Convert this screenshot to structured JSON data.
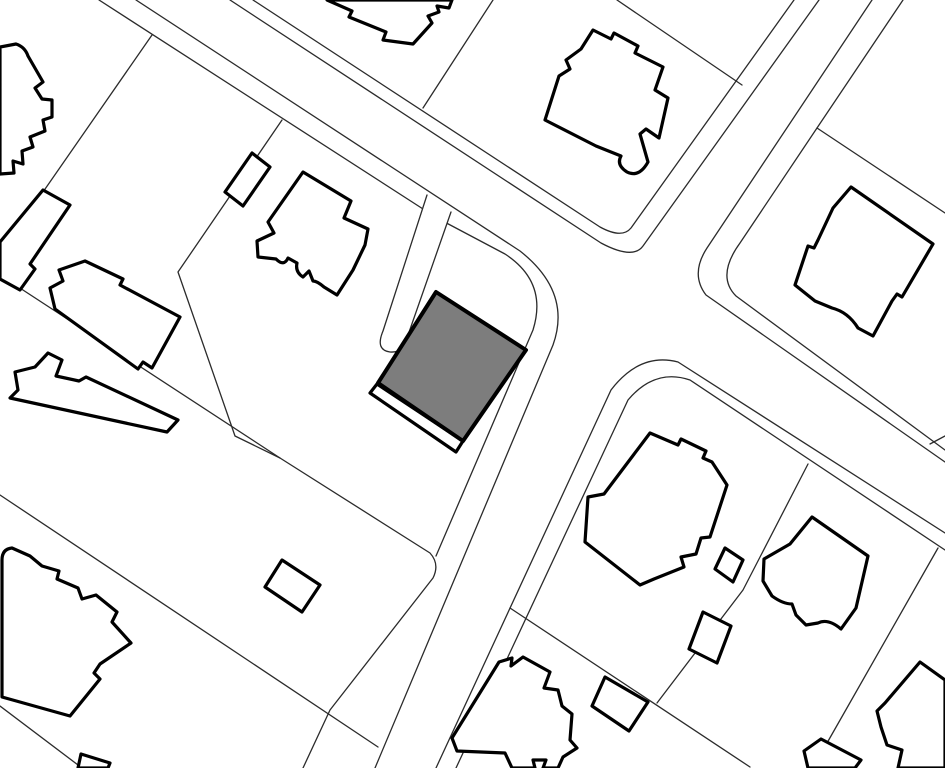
{
  "map": {
    "kind": "cadastral-parcel-map",
    "viewbox": "0 0 945 768",
    "background_color": "#ffffff",
    "parcel_line_color": "#2b2b2b",
    "parcel_line_width": 1.3,
    "building_stroke_color": "#000000",
    "building_stroke_width": 3.2,
    "building_fill": "#ffffff",
    "highlight_fill": "#7d7d7d",
    "highlight_stroke_width": 4,
    "roads": [
      {
        "name": "road-nw-ne-edge",
        "d": "M230,0 L601,243 Q633,260 643,246 L819,0"
      },
      {
        "name": "road-nw-ne-offset",
        "d": "M253,0 L600,227 Q622,239 631,228 L794,0"
      },
      {
        "name": "road-nw-sw-edge",
        "d": "M136,0 L520,251 Q572,292 553,345 L375,768"
      },
      {
        "name": "road-nw-sw-offset",
        "d": "M99,0 L437,218"
      },
      {
        "name": "road-n-e-edge",
        "d": "M872,0 L707,248 Q690,274 706,295 L945,462"
      },
      {
        "name": "road-n-e-offset",
        "d": "M903,0 L817,128 L740,243 Q716,276 736,296 L945,450"
      },
      {
        "name": "road-sw-e-edge",
        "d": "M436,768 L611,390 Q640,352 678,362 L945,533"
      },
      {
        "name": "road-sw-e-offset",
        "d": "M456,768 L628,400 Q655,368 690,380 L945,550"
      }
    ],
    "parcel_lines": [
      {
        "name": "parcel-line-tl",
        "d": "M152,35 L43,192"
      },
      {
        "name": "parcel-line-top-mid",
        "d": "M493,0 L423,108"
      },
      {
        "name": "parcel-line-top-right",
        "d": "M617,0 L742,85"
      },
      {
        "name": "parcel-line-ne",
        "d": "M817,128 L945,213"
      },
      {
        "name": "parcel-line-left-mid",
        "d": "M0,275 L280,458"
      },
      {
        "name": "parcel-line-left-low",
        "d": "M0,495 L378,747"
      },
      {
        "name": "parcel-line-corner-bl",
        "d": "M0,706 L82,768"
      },
      {
        "name": "parcel-line-w-offset-chain",
        "d": "M282,120 L178,272 L235,436 L280,458 L430,553 Q440,564 433,578 L330,710 L303,768"
      },
      {
        "name": "parcel-line-corner-lot",
        "d": "M437,218 L505,254 Q548,282 533,330 L436,556"
      },
      {
        "name": "parcel-line-se-diag",
        "d": "M510,608 L750,767"
      },
      {
        "name": "parcel-line-se-cross",
        "d": "M808,464 L743,590 L657,703"
      },
      {
        "name": "parcel-line-br-diag",
        "d": "M938,548 L827,743 L809,768"
      },
      {
        "name": "parcel-line-right-stub",
        "d": "M930,444 L945,436"
      }
    ],
    "driveway": {
      "name": "driveway-strip",
      "d": "M427,195 L383,331 Q375,350 390,352 Q405,353 407,338 L451,212"
    },
    "buildings": [
      {
        "name": "building-top-left",
        "d": "M0,47 L16,44 Q25,47 28,56 L43,82 L35,88 L42,99 L52,100 L52,117 L43,120 L45,131 L30,137 L33,147 L22,151 L23,164 L13,161 L14,173 L0,174 Z"
      },
      {
        "name": "building-left-narrow",
        "d": "M43,190 L70,205 L30,264 L35,269 L20,290 L0,279 L0,242 Z"
      },
      {
        "name": "building-left-mid",
        "d": "M85,261 L123,279 L120,285 L180,317 L152,368 L143,362 L138,369 L55,309 L50,288 L63,281 L59,270 Z"
      },
      {
        "name": "building-left-lower",
        "d": "M48,353 L62,360 L56,376 L79,381 L86,377 L178,420 L167,432 L10,398 L18,390 L15,372 L35,367 Z"
      },
      {
        "name": "building-bottom-left-house",
        "d": "M12,548 Q2,549 2,560 L2,697 L70,716 L100,679 L94,673 L100,664 L131,643 L112,622 L117,612 L96,595 L82,599 L78,588 L57,579 L59,571 L42,566 L30,556 Z"
      },
      {
        "name": "building-bottom-left-shed",
        "d": "M282,560 L320,585 L302,612 L265,587 Z"
      },
      {
        "name": "building-garage-upper",
        "d": "M252,153 L270,167 L243,206 L225,192 Z"
      },
      {
        "name": "building-mid-house",
        "d": "M303,172 L351,201 L344,218 L368,229 L365,245 L353,270 L337,295 L324,287 Q317,281 313,281 L309,271 L303,277 Q295,272 297,263 L288,258 Q284,267 276,259 L258,257 L257,241 L274,233 L268,222 Z"
      },
      {
        "name": "building-top-edge",
        "d": "M327,0 L352,11 L349,17 L386,32 L383,40 L413,44 L432,23 L428,16 L439,12 L437,6 L449,8 L452,0 Z"
      },
      {
        "name": "building-top-center-house",
        "d": "M593,30 L611,39 L614,33 L638,46 L635,53 L663,67 L655,90 L668,98 L659,138 L646,129 L640,134 L648,162 Q639,178 627,172 Q616,165 621,156 L596,146 L545,120 L559,76 L570,69 L566,60 L581,49 Z"
      },
      {
        "name": "building-top-right-house",
        "d": "M851,187 L933,244 L902,297 L897,294 L892,301 L873,336 L858,328 Q848,312 832,308 L815,301 L795,285 L808,246 L814,248 L818,240 L833,208 Z"
      },
      {
        "name": "building-se-house",
        "d": "M650,433 L678,445 L681,439 L706,451 L703,458 L712,462 L727,485 L710,537 L701,538 L696,554 L681,557 L684,567 L654,579 L640,585 L585,542 L588,497 L604,494 Z"
      },
      {
        "name": "building-se-shed-small",
        "d": "M725,548 L743,560 L733,582 L715,569 Z"
      },
      {
        "name": "building-se-shed-mid",
        "d": "M703,612 L731,626 L717,663 L689,649 Z"
      },
      {
        "name": "building-right-mid-house",
        "d": "M812,517 L868,556 L856,608 L841,629 Q828,618 818,623 L806,625 L796,615 L792,604 Q783,604 772,596 L763,581 L764,559 L790,544 Z"
      },
      {
        "name": "building-bottom-center-house",
        "d": "M499,662 L512,658 L511,666 L523,657 L550,672 L544,688 L558,690 L562,706 L572,714 L570,740 L577,748 L563,757 L558,768 L543,768 L546,760 L533,760 L535,768 L512,768 L505,753 L457,751 L452,738 Z"
      },
      {
        "name": "building-se-rect",
        "d": "M605,677 L648,702 L629,731 L592,706 Z"
      },
      {
        "name": "building-bottom-right",
        "d": "M920,662 L945,680 L945,768 L898,768 L902,750 L887,745 L881,727 L877,711 L885,703 Z"
      },
      {
        "name": "building-bottom-small",
        "d": "M821,739 L861,760 L855,768 L808,768 L804,751 Z"
      },
      {
        "name": "building-bottom-tiny",
        "d": "M81,754 L110,763 L108,768 L78,768 Z"
      }
    ],
    "highlighted_parcel": {
      "porch": {
        "name": "highlight-porch",
        "d": "M377,384 L463,441 L456,452 L370,393 Z"
      },
      "building": {
        "name": "highlighted-building",
        "d": "M436,292 L526,350 L463,441 L378,383 Z"
      }
    }
  }
}
